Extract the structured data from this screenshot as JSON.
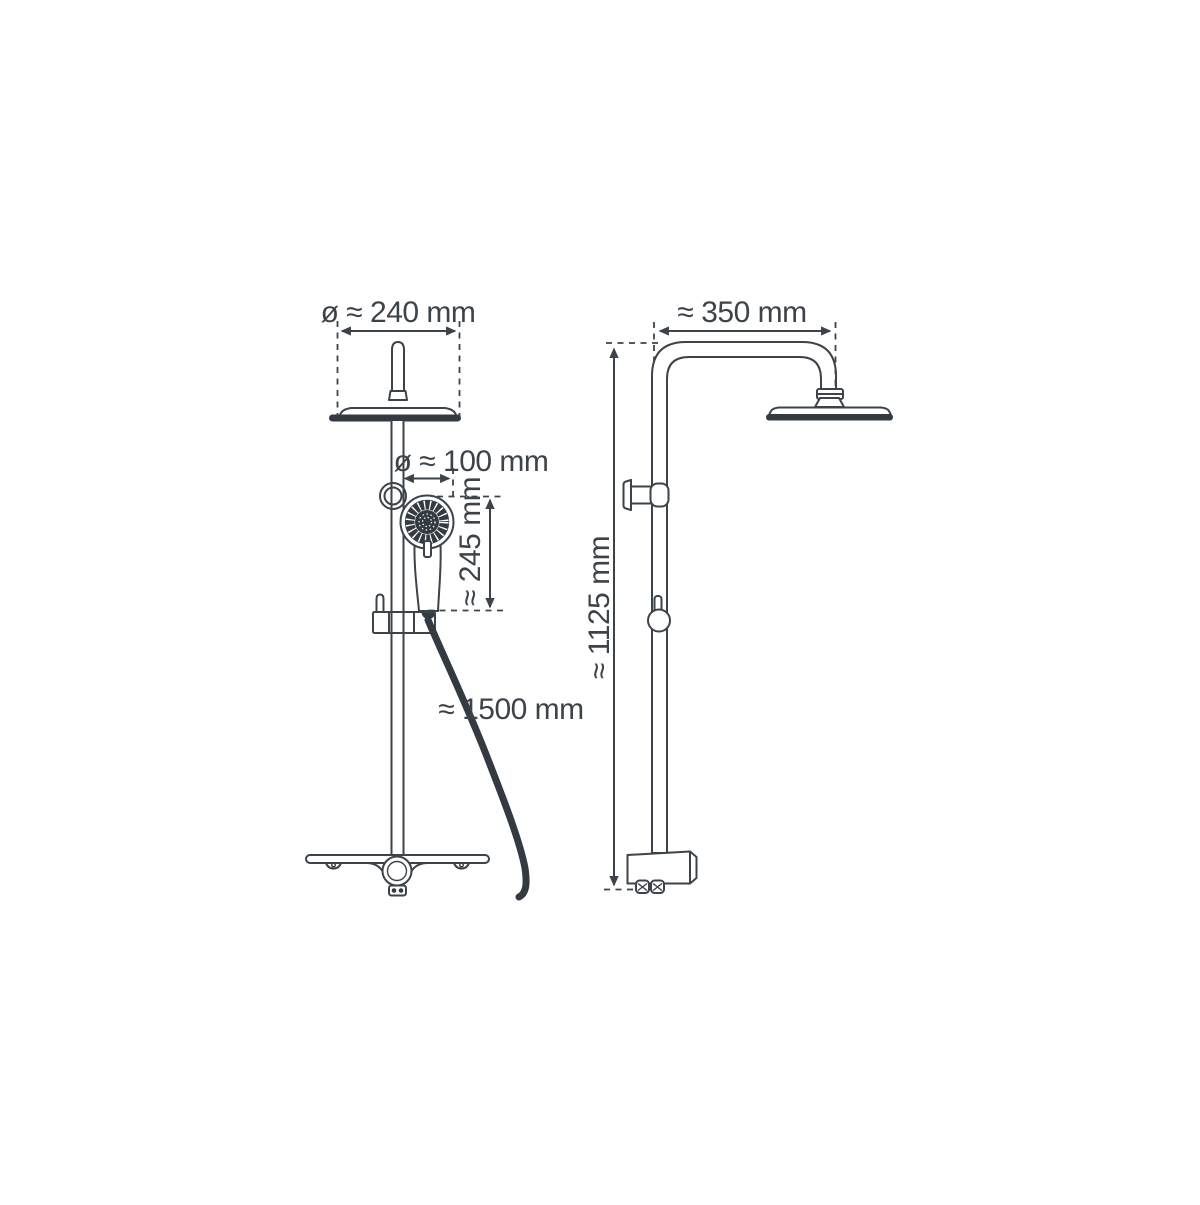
{
  "diagram_type": "shower-system-technical-drawing",
  "colors": {
    "line": "#3d434a",
    "dark_fill": "#333a41",
    "background": "#ffffff"
  },
  "front_view": {
    "head_diameter_label": "ø ≈ 240 mm",
    "hand_shower_diameter_label": "ø ≈ 100 mm",
    "hand_shower_length_label": "≈ 245 mm",
    "hose_length_label": "≈ 1500 mm"
  },
  "side_view": {
    "arm_reach_label": "≈ 350 mm",
    "column_height_label": "≈ 1125 mm"
  }
}
